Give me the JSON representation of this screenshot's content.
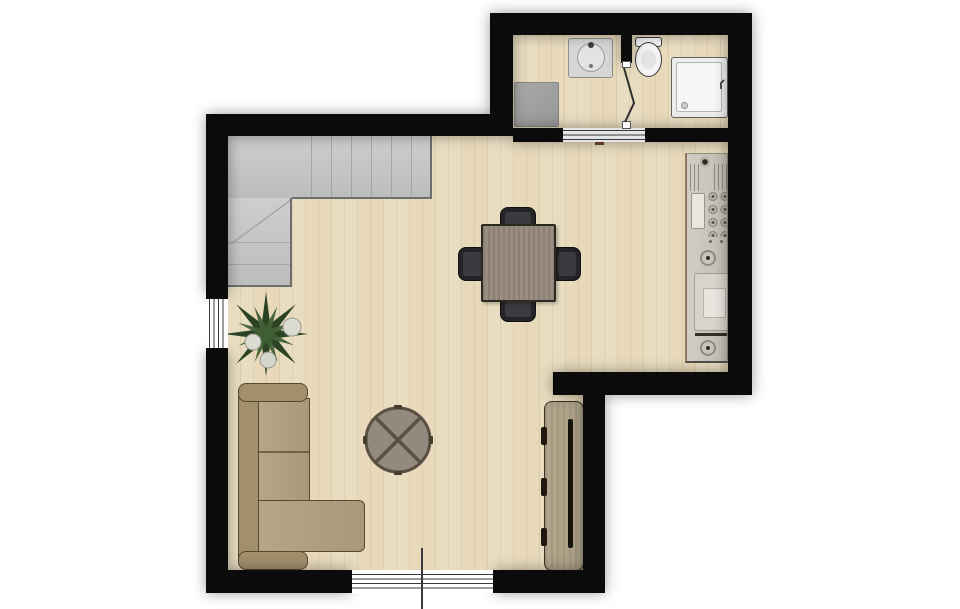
{
  "scene": {
    "type": "floor-plan",
    "rooms": [
      {
        "name": "living-dining-room"
      },
      {
        "name": "kitchenette"
      },
      {
        "name": "bathroom"
      },
      {
        "name": "staircase"
      }
    ],
    "furniture": [
      "l-shaped-staircase",
      "dining-table",
      "dining-chair x4",
      "l-shaped-sofa",
      "round-coffee-table",
      "sideboard-tv-board",
      "potted-plant",
      "kitchen-counter-strip"
    ],
    "fixtures": [
      "bathroom-sink",
      "toilet",
      "shower-tray",
      "washing-machine",
      "sliding-door-bathroom",
      "hinged-door-toilet",
      "window-left",
      "window-bottom",
      "leader-line"
    ]
  },
  "palette": {
    "wall": "#0b0b0b",
    "outside": "#ffffff",
    "floor_base": "#e7d9ba",
    "stairs": "#c7c7c7",
    "stair_line": "#a6a6a6",
    "stair_edge": "#6e6e6e",
    "sofa_body": "#a28f6c",
    "sofa_seat": "#b19f7d",
    "sofa_outline": "#57482f",
    "table_top": "#94877a",
    "table_edge": "#2c2822",
    "chair_dark": "#242427",
    "chair_seat": "#3a3a3f",
    "coffee_fill": "#92897f",
    "coffee_ring": "#5a4f41",
    "sideboard": "#aa9d83",
    "sideboard_edge": "#3a3124",
    "tv_line": "#17140e",
    "counter": "#c9c5bb",
    "counter_line": "#948e82",
    "fixture_line": "#3e3e3e",
    "fixture_fill": "#f3f3f3",
    "washer": "#a0a0a0",
    "shower_tray": "#f5f5f5",
    "plant_dark": "#2b4323",
    "plant_light": "#416036",
    "bloom": "#dcdbd3",
    "glazing": "#383838",
    "door_panel": "#e4e4e4",
    "door_mark": "#5e3a26",
    "leader": "#3a3a3a"
  }
}
